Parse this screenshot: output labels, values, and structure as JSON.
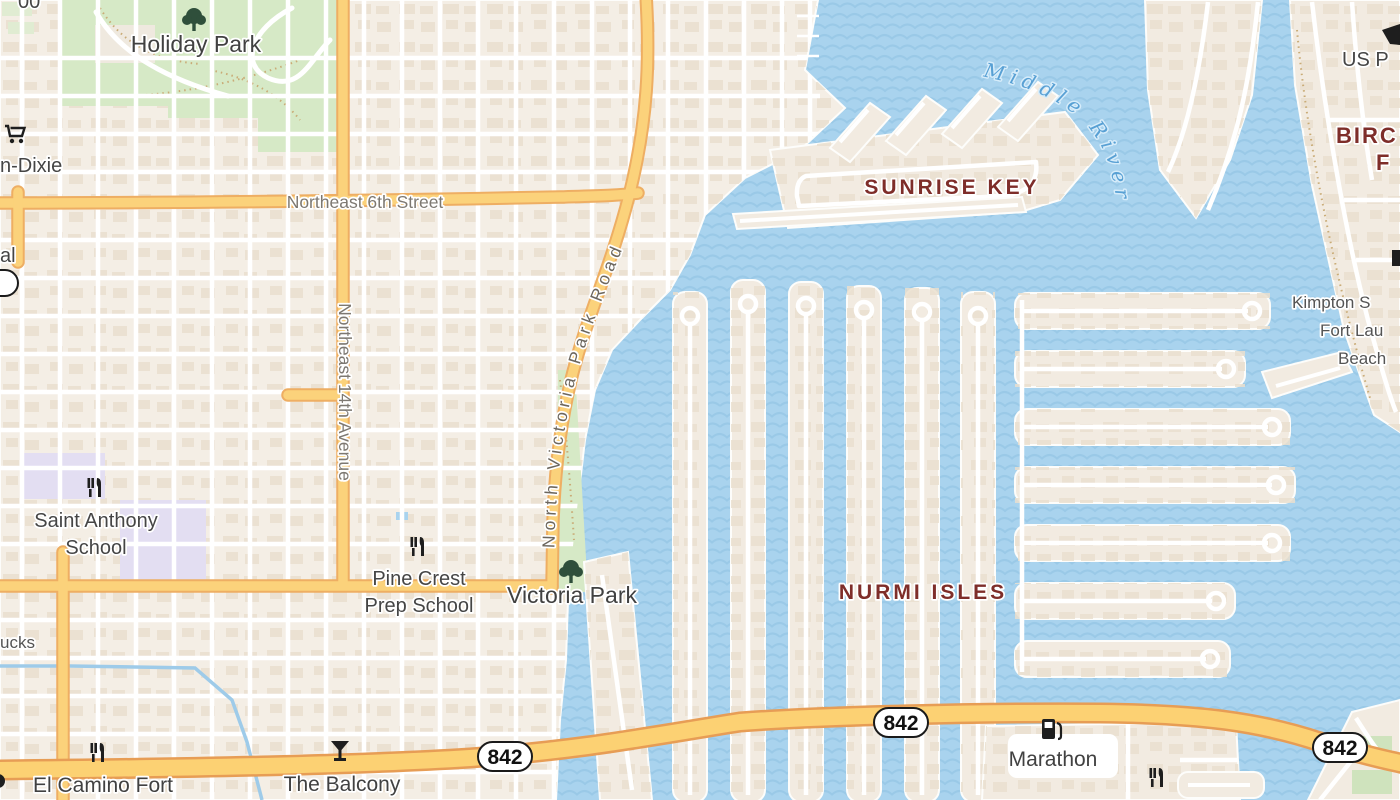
{
  "labels": {
    "parks": {
      "holiday_park": "Holiday Park",
      "victoria_park": "Victoria Park"
    },
    "streets": {
      "ne_6th_street": "Northeast 6th Street",
      "ne_14th_avenue": "Northeast 14th Avenue",
      "n_victoria_park_road": "North Victoria Park Road"
    },
    "areas": {
      "sunrise_key": "SUNRISE KEY",
      "nurmi_isles": "NURMI ISLES",
      "birch_partial_line1": "BIRC",
      "birch_partial_line2": "F"
    },
    "water": {
      "middle_river": "Middle River"
    },
    "pois": {
      "winn_dixie_partial": "n-Dixie",
      "partial_al": "al",
      "starbucks_partial": "ucks",
      "partial_top_left": "00",
      "saint_anthony_line1": "Saint Anthony",
      "saint_anthony_line2": "School",
      "pine_crest_line1": "Pine Crest",
      "pine_crest_line2": "Prep School",
      "el_camino": "El Camino Fort",
      "the_balcony": "The Balcony",
      "marathon": "Marathon",
      "us_post_partial": "US P",
      "kimpton_line1": "Kimpton S",
      "kimpton_line2": "Fort Lau",
      "kimpton_line3": "Beach"
    }
  },
  "shields": {
    "route_842": "842"
  },
  "colors": {
    "water": "#a9d3ee",
    "wave": "#8ec0e2",
    "land": "#f4eee5",
    "buildings": "#eadfcf",
    "park_green": "#d6e9c6",
    "school_lavender": "#e3def2",
    "road_yellow": "#fbd27b",
    "road_yellow_casing": "#eeae63",
    "highway_yellow": "#fcd173",
    "highway_casing": "#e79d55",
    "area_label": "#7e2d29",
    "water_label": "#58a0d4",
    "street_label": "#7d7871",
    "poi_label": "#454545",
    "icon_black": "#1e1e1e",
    "tree_green": "#2f4f3b"
  }
}
